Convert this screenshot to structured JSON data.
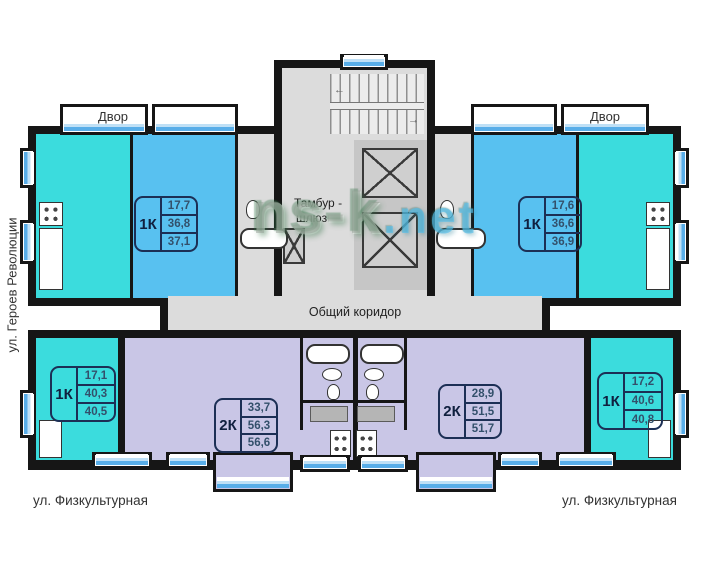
{
  "labels": {
    "dvor_left": "Двор",
    "dvor_right": "Двор",
    "street_left_vertical": "ул. Героев Революции",
    "street_bottom_left": "ул. Физкультурная",
    "street_bottom_right": "ул. Физкультурная",
    "vestibule_line1": "Тамбур -",
    "vestibule_line2": "шлюз",
    "corridor": "Общий коридор"
  },
  "watermark": {
    "part1": "ns-k",
    "part2": ".net"
  },
  "apartments": [
    {
      "zone": "upper-left",
      "type": "1К",
      "areas": [
        "17,7",
        "36,8",
        "37,1"
      ]
    },
    {
      "zone": "upper-right",
      "type": "1К",
      "areas": [
        "17,6",
        "36,6",
        "36,9"
      ]
    },
    {
      "zone": "lower-left",
      "type": "1К",
      "areas": [
        "17,1",
        "40,3",
        "40,5"
      ]
    },
    {
      "zone": "lower-mid-left",
      "type": "2К",
      "areas": [
        "33,7",
        "56,3",
        "56,6"
      ]
    },
    {
      "zone": "lower-mid-right",
      "type": "2К",
      "areas": [
        "28,9",
        "51,5",
        "51,7"
      ]
    },
    {
      "zone": "lower-right",
      "type": "1К",
      "areas": [
        "17,2",
        "40,6",
        "40,8"
      ]
    }
  ],
  "colors": {
    "wall": "#161616",
    "turquoise_room": "#3bdcdd",
    "blue_room": "#58c1f0",
    "lavender_room": "#c9c6e6",
    "gray_area": "#dcdcdc",
    "window_blue": "#58ade8",
    "info_border": "#1c2f55"
  }
}
